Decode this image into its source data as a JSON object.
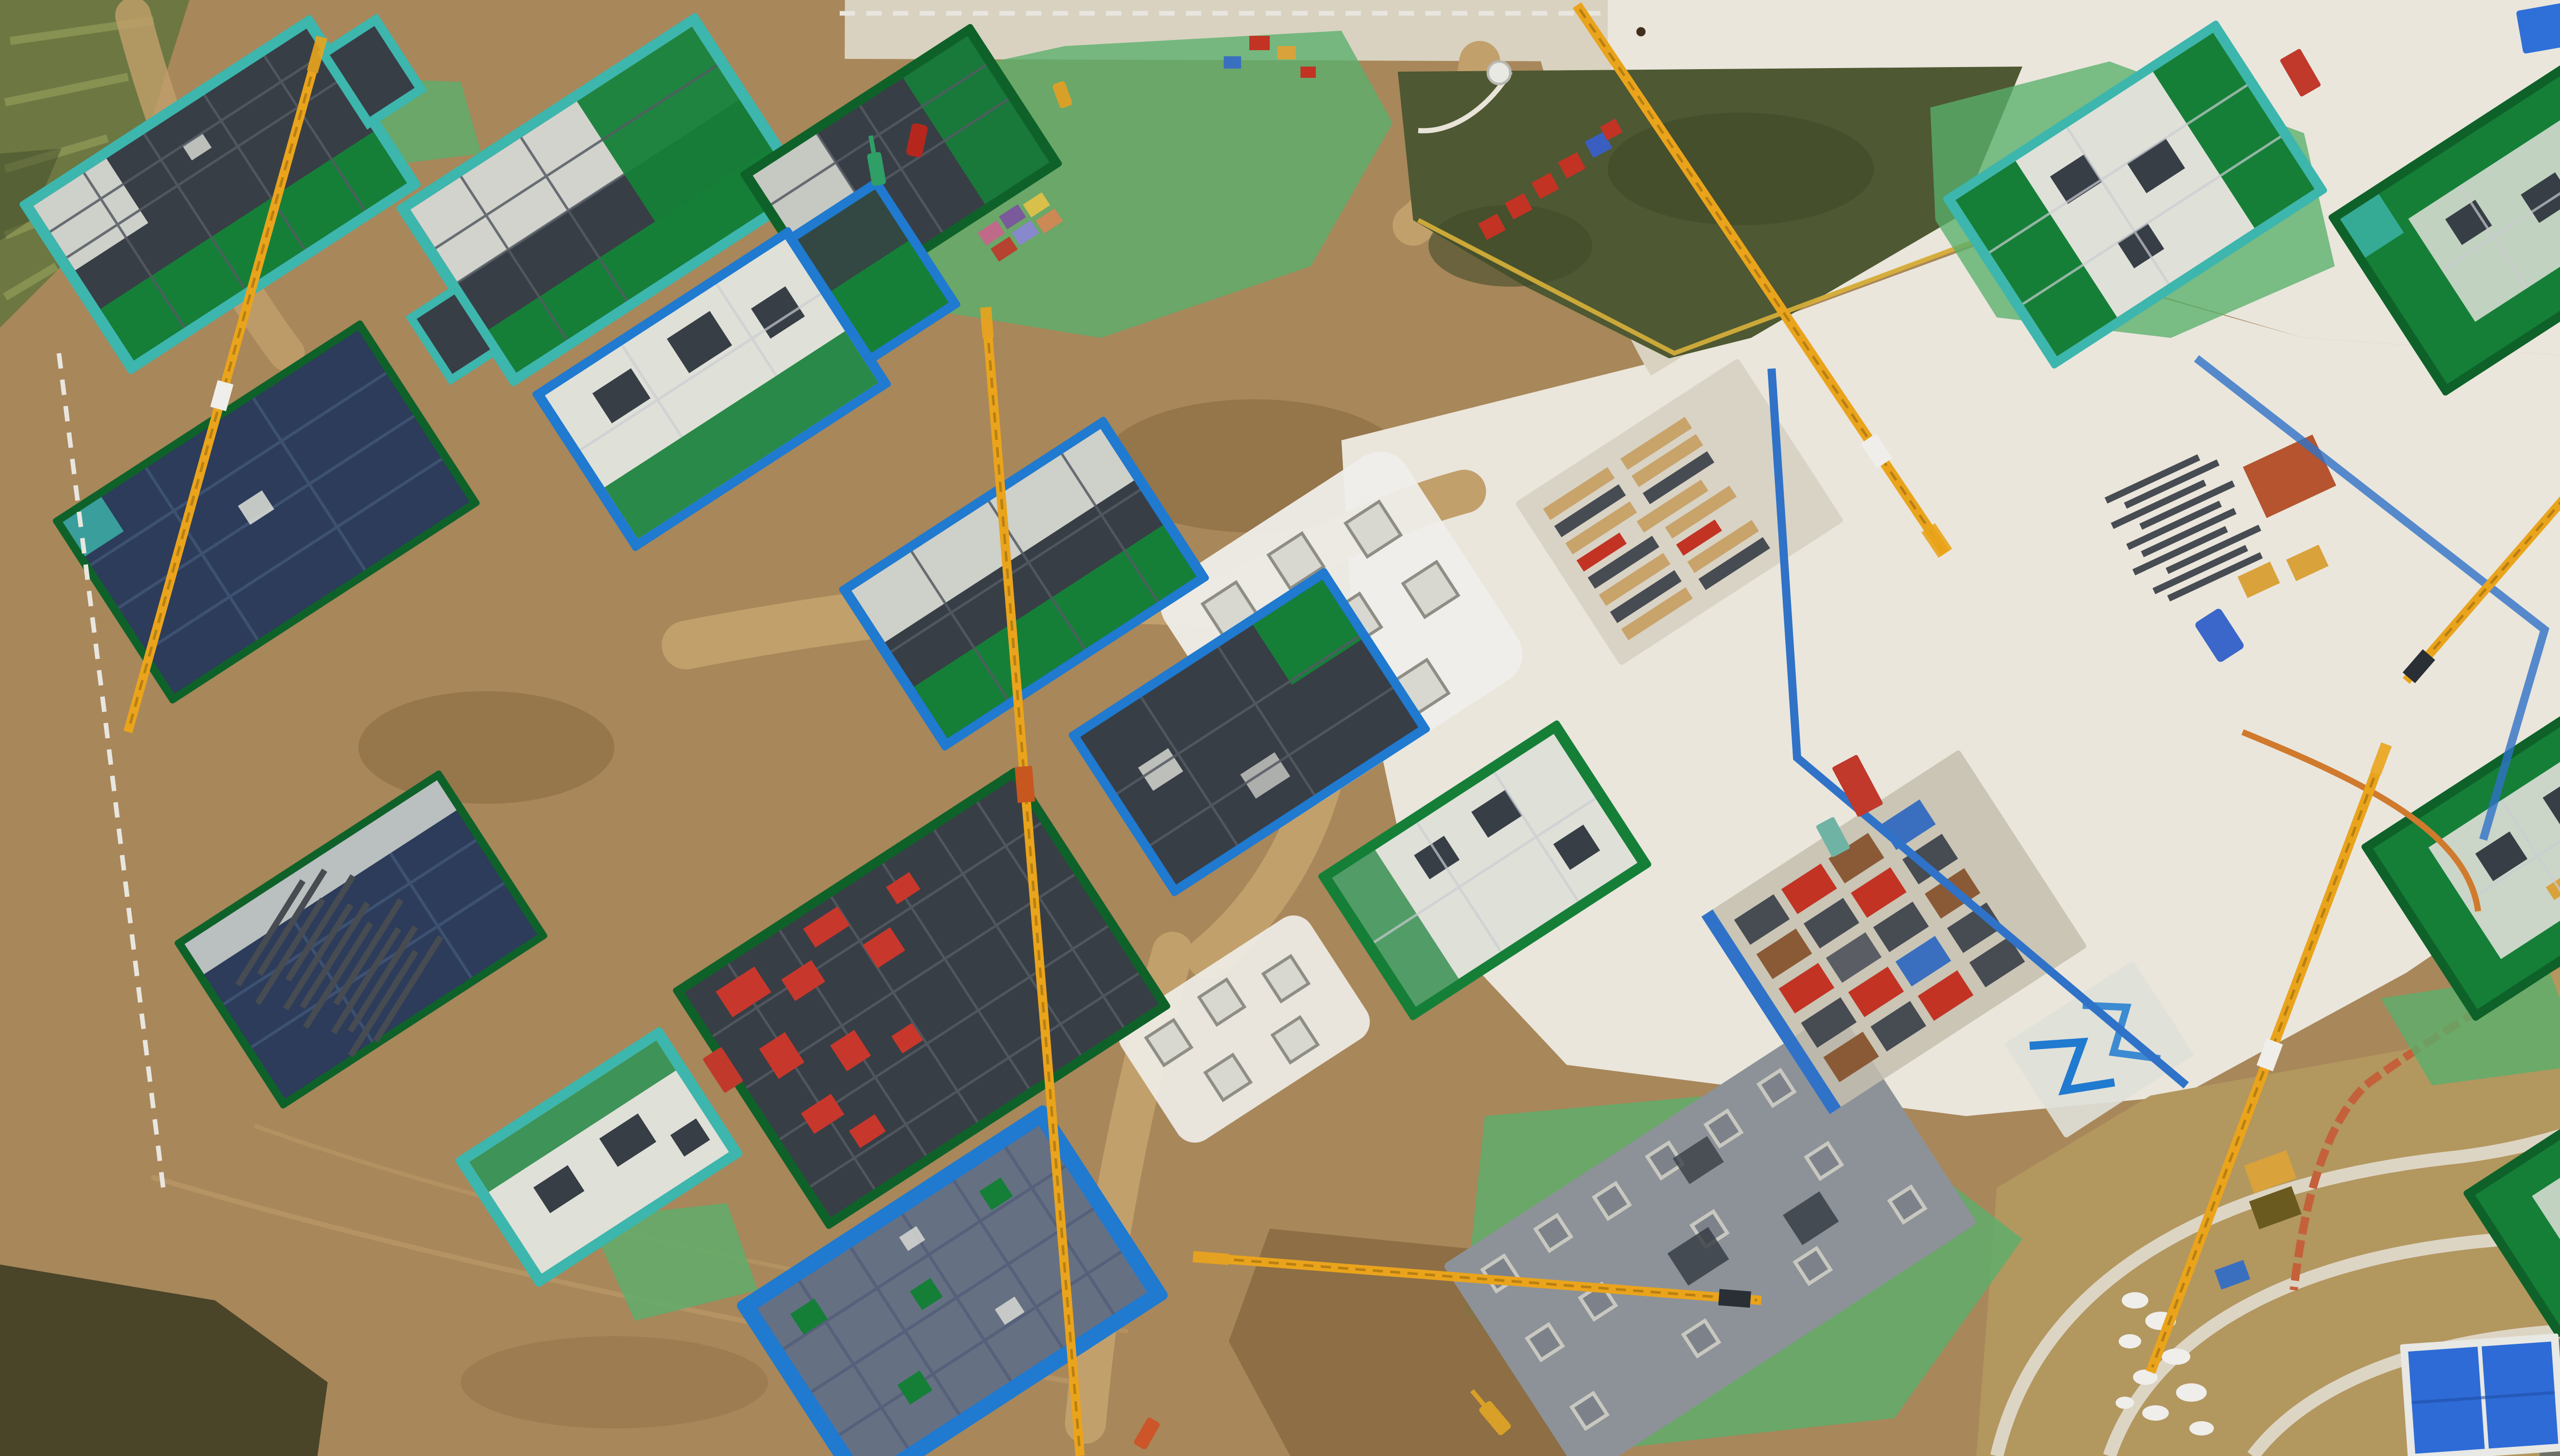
{
  "scene": {
    "title": "Aerial drone photograph of a large residential construction site",
    "description": "Top-down dusk view of dozens of mid-rise apartment buildings under construction: green safety netting and teal edge protection on slabs, yellow tower cranes, dark formwork decks with red panels, blue-outlined foundation slabs, concrete plazas with blue lane lines, bare earth, green dust-control mesh, a dark lawn with red sign characters, farmland at top-left, and curved terraced embankment roads at bottom-right.",
    "palette": {
      "dirt": "#a8875a",
      "dirt_light": "#c2a06c",
      "dirt_dark": "#8a6c42",
      "road": "#d9d2c0",
      "plaza": "#eae6dc",
      "farmland": "#6d7742",
      "farm_stripe": "#8c9756",
      "scrub": "#4a4429",
      "lawn": "#4e5832",
      "lawn_dark": "#414b2a",
      "trees": "#2f4526",
      "grass_brown": "#6e6239",
      "terrace_grass": "#b2975f",
      "wall": "#ddd5c4",
      "net_green": "#157f38",
      "net_dark": "#0e6229",
      "teal": "#3db6ad",
      "blue_edge": "#1f7ad0",
      "blue_line": "#2f72c8",
      "navy": "#2c3c5a",
      "navy_light": "#3d5170",
      "slab_white": "#dfe0d8",
      "form_dark": "#383e45",
      "form_line": "#555b63",
      "form_red": "#c8372c",
      "crane": "#eaa41c",
      "crane_dark": "#b87f12",
      "mesh": "#58b06b",
      "gray_slab": "#8d9298",
      "gray_slab_dark": "#7d828a",
      "orange_fence": "#c4613a",
      "blue_roof": "#2e6bd6",
      "dark_pave": "#6e7066",
      "white": "#efeeea",
      "red": "#c23324",
      "wood": "#c8a36a",
      "steel": "#474b52",
      "fence_white": "#e8e6df",
      "yellow_stack": "#d9a23a"
    },
    "objects": [
      {
        "name": "building-under-construction",
        "description": "16 zigzag-plan apartment blocks wrapped in green netting with teal/white/blue slab edge protection"
      },
      {
        "name": "tower-crane",
        "description": "6 yellow lattice tower crane jibs crossing the site"
      },
      {
        "name": "navy-roof-deck",
        "description": "Two large dark navy waterproofed roof decks on the left"
      },
      {
        "name": "red-formwork-deck",
        "description": "Large charcoal formwork deck scattered with red aluminum formwork panels"
      },
      {
        "name": "blue-outlined-slab",
        "description": "Foundation slab with bright blue edge protection at bottom-center-left"
      },
      {
        "name": "gray-foundation-slab",
        "description": "Plain gray raft slab with square pile caps at bottom-center"
      },
      {
        "name": "concrete-plaza",
        "description": "Large light concrete hardstand with blue painted lane lines on the right half"
      },
      {
        "name": "lawn-with-red-characters",
        "description": "Dark green lawn triangle with red sign characters near top-center"
      },
      {
        "name": "farmland",
        "description": "Olive striped crop fields in the top-left corner"
      },
      {
        "name": "dust-control-mesh",
        "description": "Bright green mesh tarps covering soil in several areas"
      },
      {
        "name": "rebar-laydown-yard",
        "description": "Bundles of dark steel rebar stored left-center and right-center"
      },
      {
        "name": "lumber-yard",
        "description": "Timber and formwork stacks on the plaza"
      },
      {
        "name": "terraced-embankment",
        "description": "Curved stone retaining walls and tan grass slopes at bottom-right"
      },
      {
        "name": "blue-roof-shed",
        "description": "Bright blue metal roof building at bottom-right"
      },
      {
        "name": "red-truck",
        "description": "Red semi truck with trailers parked on the upper-right road"
      },
      {
        "name": "red-car",
        "description": "Small red car parked near the top-center"
      },
      {
        "name": "excavators",
        "description": "Green, yellow and orange mini excavators"
      },
      {
        "name": "white-silo-tank",
        "description": "Round white tanks near the top-right buildings"
      },
      {
        "name": "site-fences",
        "description": "White hoarding panels along the left and top boundaries, orange fence along bottom-right curve"
      },
      {
        "name": "haul-roads",
        "description": "Tan dirt haul roads winding between foundations"
      }
    ]
  }
}
